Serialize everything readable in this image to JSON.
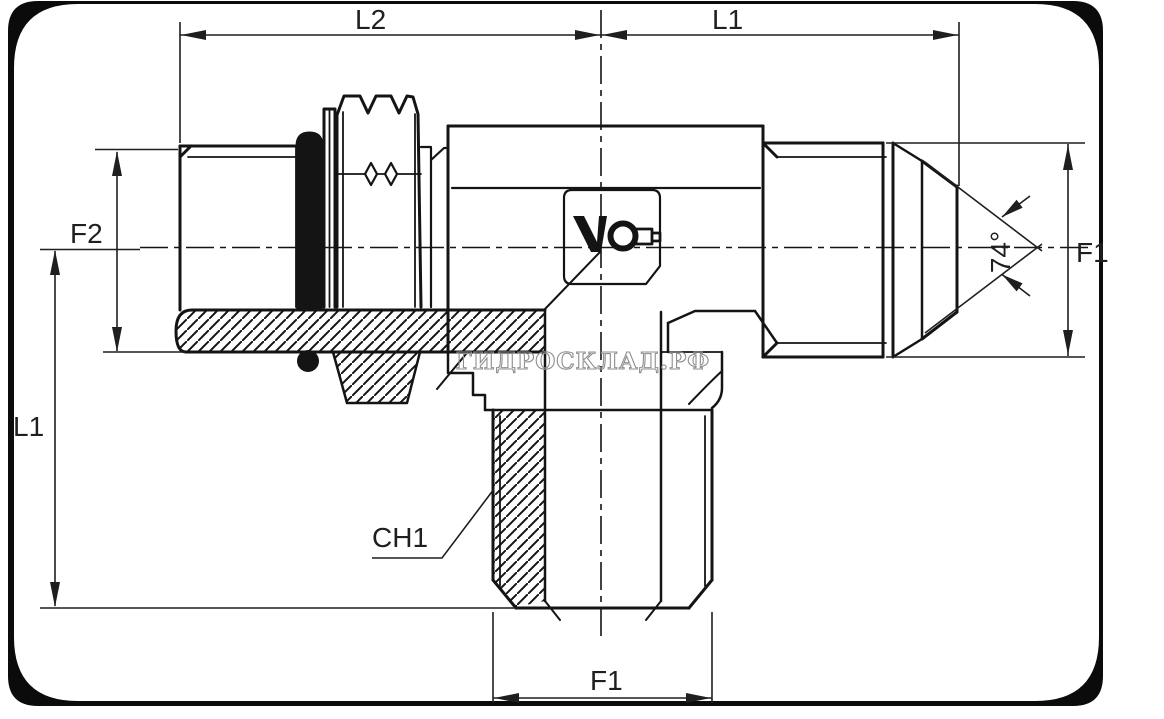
{
  "page": {
    "background": "#ffffff"
  },
  "frame": {
    "color": "#0b0b0b"
  },
  "drawing": {
    "kind": "technical-drawing",
    "subject": "hydraulic adjustable tee stud fitting, side view with broken-out section",
    "line_color": "#141414",
    "hatch_color": "#141414"
  },
  "watermark": {
    "text": "ГИДРОСКЛАД.РФ",
    "color": "#8f8f8f"
  },
  "labels": {
    "l2": "L2",
    "l1_top": "L1",
    "f2": "F2",
    "l1_left": "L1",
    "f1_right": "F1",
    "f1_bottom": "F1",
    "ch1": "CH1",
    "angle": "74°"
  }
}
